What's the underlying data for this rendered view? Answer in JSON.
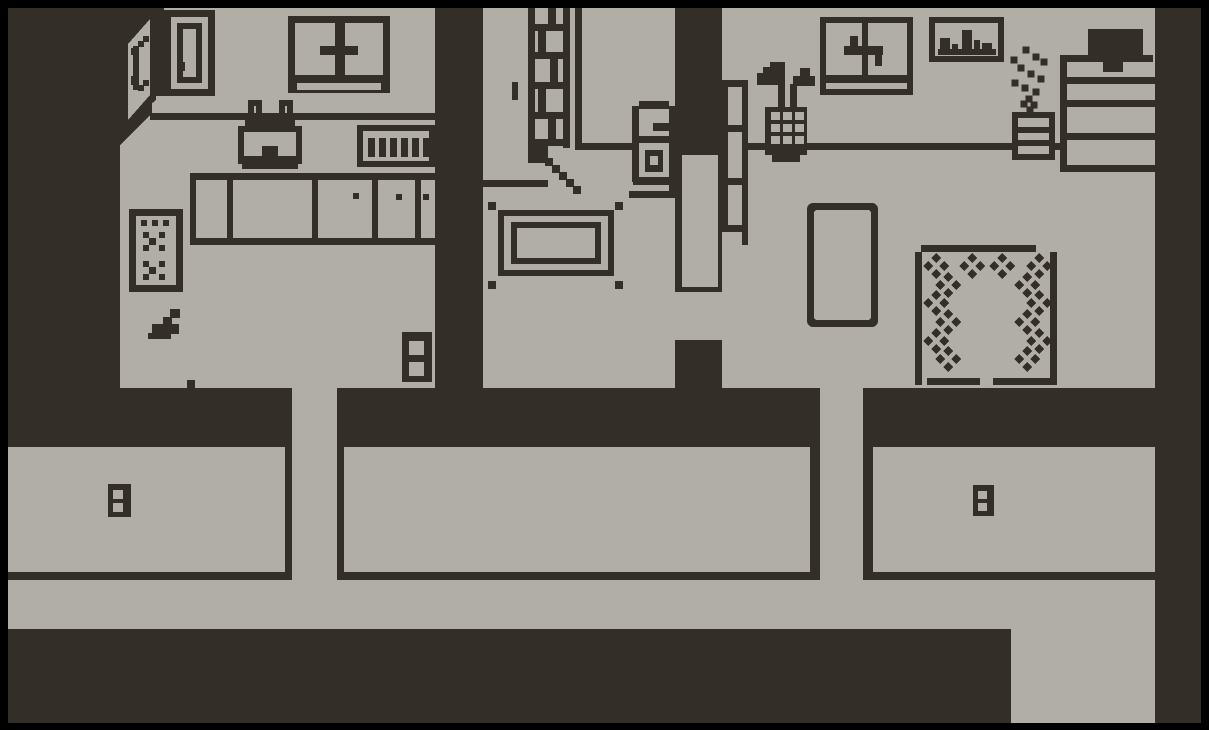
{
  "colors": {
    "ink": "#332f28",
    "paper": "#b1aea6",
    "frame": "#000000"
  },
  "scene": {
    "style": "1-bit pixel art",
    "rooms": [
      {
        "id": "kitchen",
        "objects": [
          "corner-cabinet-door",
          "wall-cupboard",
          "window",
          "kettle",
          "dish-rack",
          "counter-cabinets",
          "stove",
          "scoop",
          "wall-outlet"
        ]
      },
      {
        "id": "hall",
        "objects": [
          "brick-chimney",
          "wall-switch",
          "table",
          "furnace",
          "doorway",
          "floor-hatch"
        ]
      },
      {
        "id": "living-room",
        "objects": [
          "wall-ladder",
          "umbrella-stand",
          "window",
          "skyline-picture",
          "potted-plant",
          "bookshelf",
          "tv",
          "floor-mat",
          "diamond-rug"
        ]
      },
      {
        "id": "basement-left",
        "objects": [
          "double-window-door"
        ]
      },
      {
        "id": "basement-middle",
        "objects": []
      },
      {
        "id": "basement-right",
        "objects": [
          "double-window-door"
        ]
      }
    ]
  },
  "rug": {
    "cluster_centers": [
      [
        936,
        266
      ],
      [
        972,
        266
      ],
      [
        1002,
        266
      ],
      [
        1039,
        266
      ],
      [
        948,
        285
      ],
      [
        936,
        303
      ],
      [
        948,
        322
      ],
      [
        936,
        341
      ],
      [
        948,
        359
      ],
      [
        1027,
        285
      ],
      [
        1039,
        303
      ],
      [
        1027,
        322
      ],
      [
        1039,
        341
      ],
      [
        1027,
        359
      ]
    ],
    "offsets": [
      [
        0,
        -8
      ],
      [
        8,
        0
      ],
      [
        0,
        8
      ],
      [
        -8,
        0
      ]
    ],
    "radius": 5
  },
  "plant": {
    "dots": [
      [
        1026,
        50
      ],
      [
        1036,
        57
      ],
      [
        1014,
        60
      ],
      [
        1044,
        62
      ],
      [
        1021,
        68
      ],
      [
        1031,
        74
      ],
      [
        1041,
        79
      ],
      [
        1015,
        83
      ],
      [
        1025,
        88
      ],
      [
        1036,
        92
      ],
      [
        1029,
        99
      ],
      [
        1034,
        105
      ],
      [
        1024,
        104
      ],
      [
        1030,
        110
      ]
    ],
    "size": 7
  }
}
